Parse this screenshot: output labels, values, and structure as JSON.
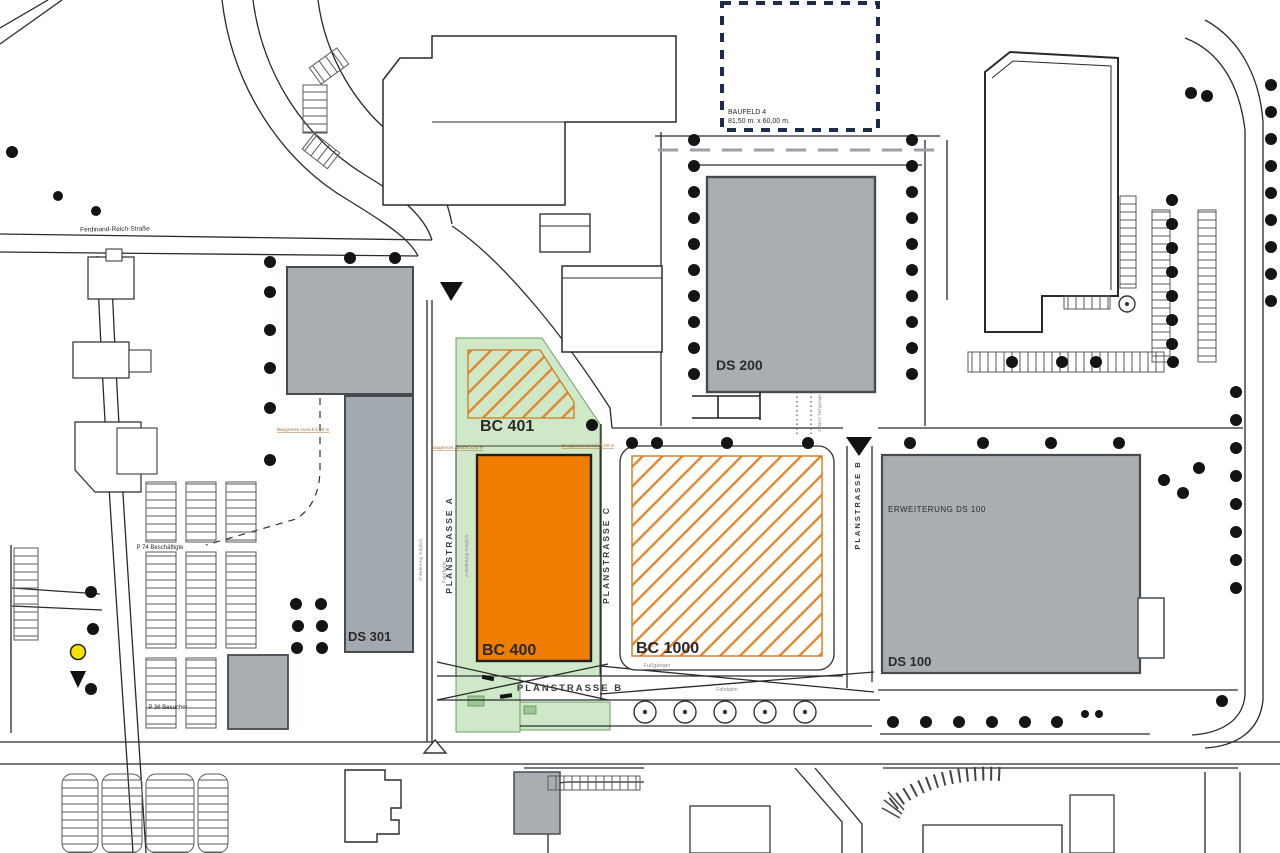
{
  "plots": {
    "bc400": "BC 400",
    "bc401": "BC 401",
    "bc1000": "BC 1000",
    "ds100": "DS 100",
    "ds100_erweiterung": "ERWEITERUNG DS 100",
    "ds200": "DS 200",
    "ds301": "DS 301",
    "baufeld4": "BAUFELD 4",
    "baufeld4_dim": "81,50 m. x 60,00 m."
  },
  "streets": {
    "planstrasse_a": "PLANSTRASSE A",
    "planstrasse_b_vertical": "PLANSTRASSE B",
    "planstrasse_b_horizontal": "PLANSTRASSE B",
    "planstrasse_c": "PLANSTRASSE C",
    "ferdinand_reich": "Ferdinand-Reich-Straße"
  },
  "annotations": {
    "p74": "P 74 Beschäftigte",
    "p36": "P 36 Besucher",
    "fahrbahn_a": "Fahrbahn",
    "fahrbahn_b": "Fahrbahn",
    "fussgaenger": "Fußgänger",
    "anlieferung_1": "Anlieferung möglich",
    "anlieferung_2": "Anlieferung möglich",
    "baugrenze_1": "Baugrenze zurück 5,00 m",
    "baugrenze_2": "Baugrenze zurück 5,00 m",
    "baugrenze_3": "Baugrenze zurück 5,00 m",
    "zufahrt_tiefgarage": "Zufahrt Tiefgarage"
  },
  "colors": {
    "plot_orange": "#f07d00",
    "hatch_orange": "#e0862c",
    "building_gray": "#a9aeb3",
    "green_area": "#cfe9c8",
    "marker_yellow": "#f4e300",
    "baufeld_dash": "#1d2b4d"
  }
}
